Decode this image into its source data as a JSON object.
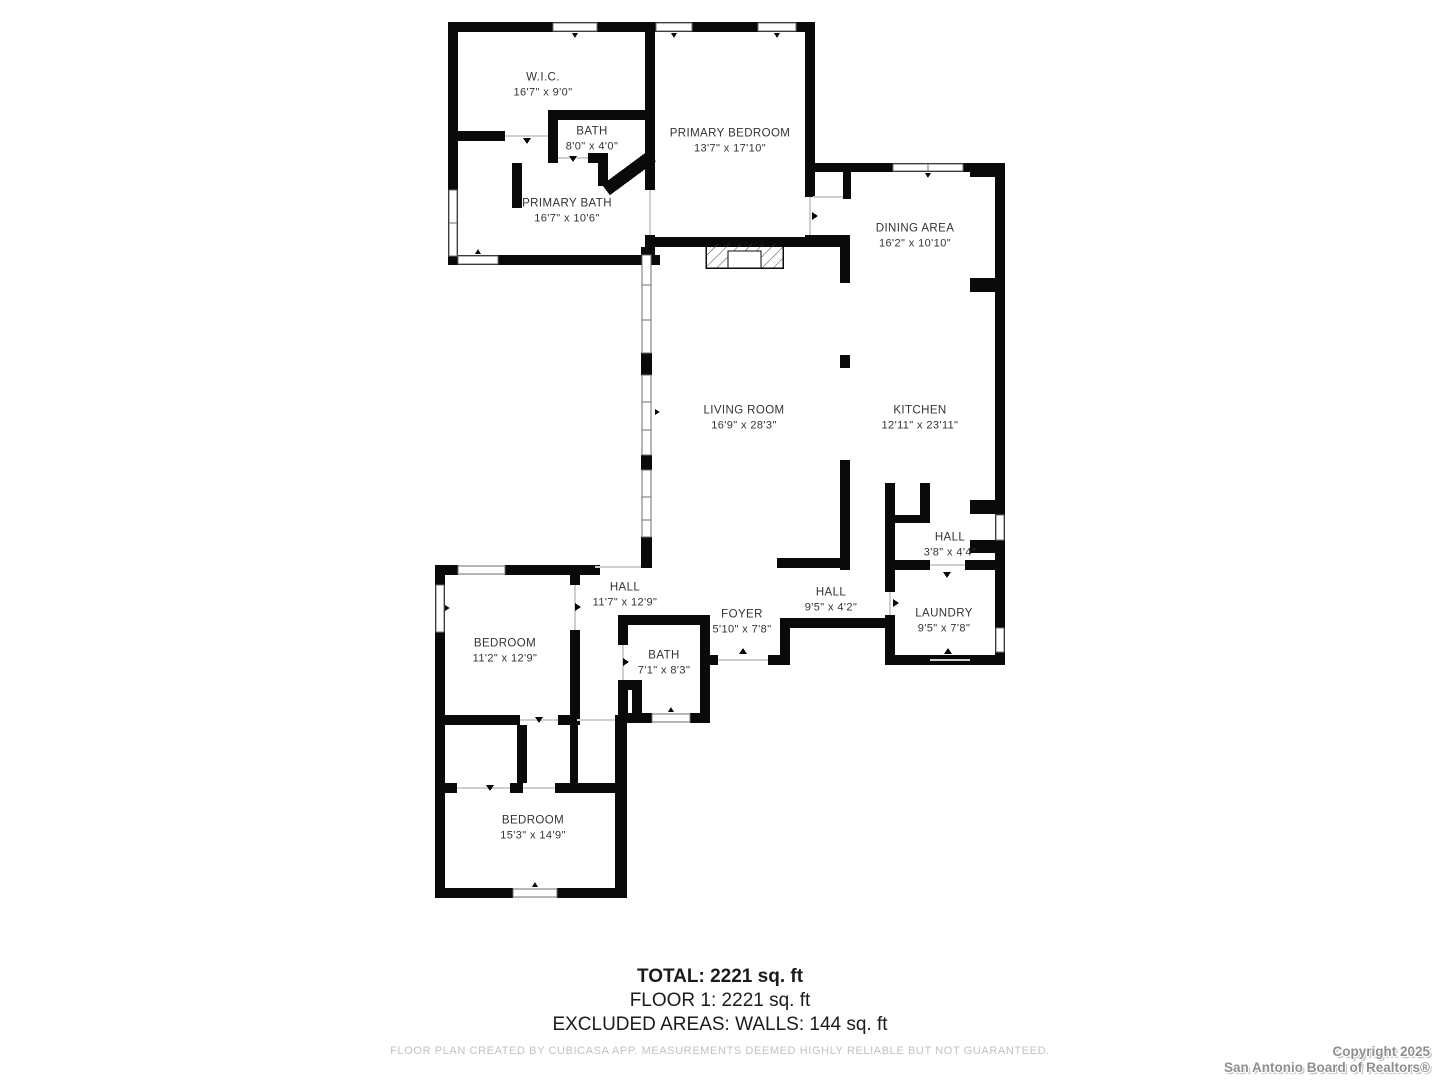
{
  "floorplan": {
    "rooms": [
      {
        "name": "W.I.C.",
        "dims": "16'7\" x 9'0\""
      },
      {
        "name": "BATH",
        "dims": "8'0\" x 4'0\""
      },
      {
        "name": "PRIMARY BEDROOM",
        "dims": "13'7\" x 17'10\""
      },
      {
        "name": "PRIMARY BATH",
        "dims": "16'7\" x 10'6\""
      },
      {
        "name": "DINING AREA",
        "dims": "16'2\" x 10'10\""
      },
      {
        "name": "LIVING ROOM",
        "dims": "16'9\" x 28'3\""
      },
      {
        "name": "KITCHEN",
        "dims": "12'11\" x 23'11\""
      },
      {
        "name": "HALL",
        "dims": "3'8\" x 4'4\""
      },
      {
        "name": "HALL",
        "dims": "11'7\" x 12'9\""
      },
      {
        "name": "FOYER",
        "dims": "5'10\" x 7'8\""
      },
      {
        "name": "HALL",
        "dims": "9'5\" x 4'2\""
      },
      {
        "name": "LAUNDRY",
        "dims": "9'5\" x 7'8\""
      },
      {
        "name": "BEDROOM",
        "dims": "11'2\" x 12'9\""
      },
      {
        "name": "BATH",
        "dims": "7'1\" x 8'3\""
      },
      {
        "name": "BEDROOM",
        "dims": "15'3\" x 14'9\""
      }
    ],
    "summary": {
      "total": "TOTAL: 2221 sq. ft",
      "floor1": "FLOOR 1: 2221 sq. ft",
      "excluded": "EXCLUDED AREAS: WALLS: 144 sq. ft"
    },
    "disclaimer": "FLOOR PLAN CREATED BY CUBICASA APP. MEASUREMENTS DEEMED HIGHLY RELIABLE BUT NOT GUARANTEED.",
    "copyright": {
      "line1": "Copyright 2025",
      "line2": "San Antonio Board of Realtors®"
    },
    "colors": {
      "wall": "#0a0a0a",
      "label": "#333333",
      "disclaimer": "#c2c2c2",
      "watermark": "#8f8f8f"
    }
  }
}
